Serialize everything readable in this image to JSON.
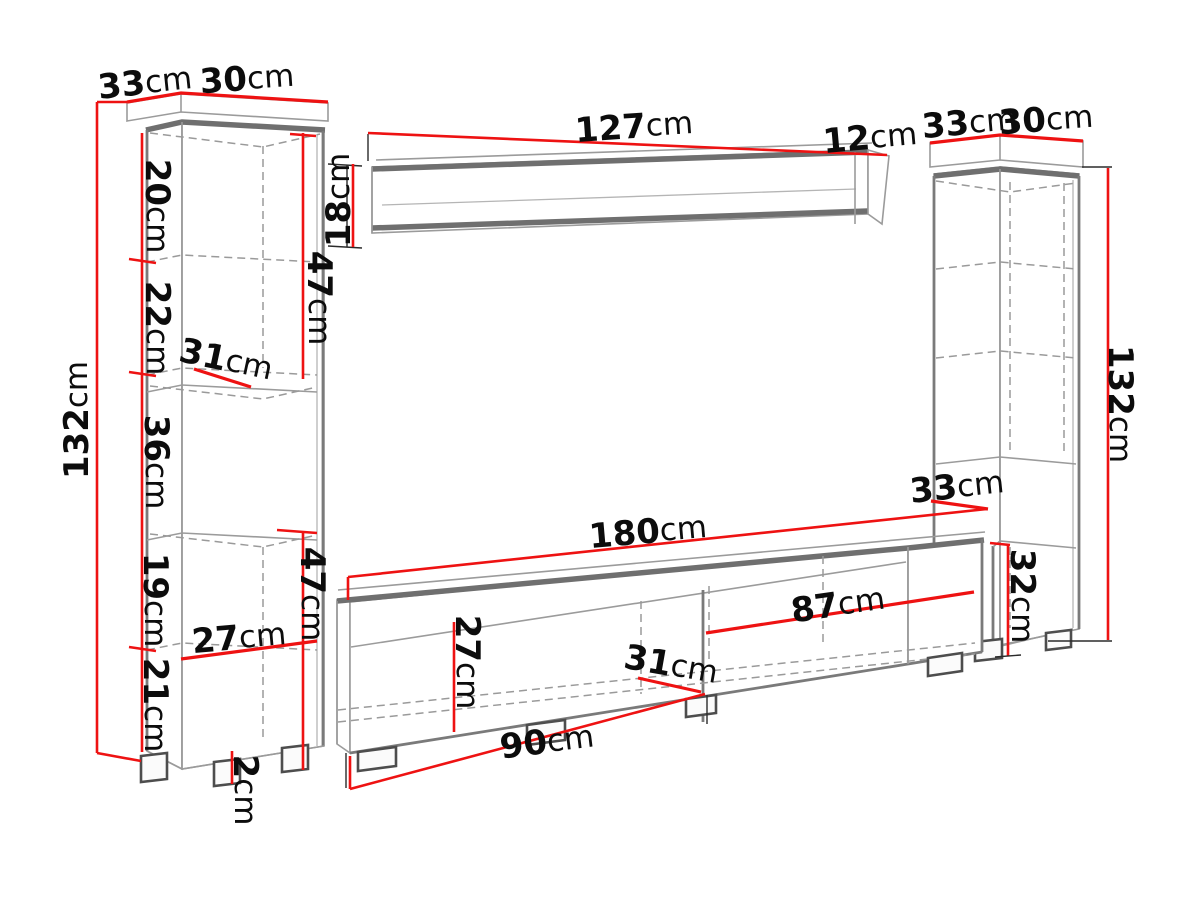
{
  "diagram": {
    "background": "#ffffff",
    "accent_red": "#ee1212",
    "outline_gray": "#6f6f6f",
    "left_cabinet": {
      "top_depth": {
        "v": "33",
        "u": "cm"
      },
      "top_width": {
        "v": "30",
        "u": "cm"
      },
      "height": {
        "v": "132",
        "u": "cm"
      },
      "shelf_top": {
        "v": "20",
        "u": "cm"
      },
      "shelf_second": {
        "v": "22",
        "u": "cm"
      },
      "upper_door_height": {
        "v": "47",
        "u": "cm"
      },
      "inner_depth": {
        "v": "31",
        "u": "cm"
      },
      "open_section_height": {
        "v": "36",
        "u": "cm"
      },
      "shelf_fourth": {
        "v": "19",
        "u": "cm"
      },
      "shelf_bottom": {
        "v": "21",
        "u": "cm"
      },
      "inner_width": {
        "v": "27",
        "u": "cm"
      },
      "lower_door_height": {
        "v": "47",
        "u": "cm"
      },
      "foot_height": {
        "v": "2",
        "u": "cm"
      }
    },
    "wall_shelf": {
      "width": {
        "v": "127",
        "u": "cm"
      },
      "end_depth": {
        "v": "12",
        "u": "cm"
      },
      "height": {
        "v": "18",
        "u": "cm"
      }
    },
    "right_cabinet": {
      "top_depth": {
        "v": "33",
        "u": "cm"
      },
      "top_width": {
        "v": "30",
        "u": "cm"
      },
      "height": {
        "v": "132",
        "u": "cm"
      },
      "mid_depth": {
        "v": "33",
        "u": "cm"
      },
      "lower_door_height": {
        "v": "32",
        "u": "cm"
      }
    },
    "tv_stand": {
      "width": {
        "v": "180",
        "u": "cm"
      },
      "inner_height": {
        "v": "27",
        "u": "cm"
      },
      "right_door_width": {
        "v": "87",
        "u": "cm"
      },
      "inner_depth": {
        "v": "31",
        "u": "cm"
      },
      "left_door_width": {
        "v": "90",
        "u": "cm"
      }
    }
  }
}
